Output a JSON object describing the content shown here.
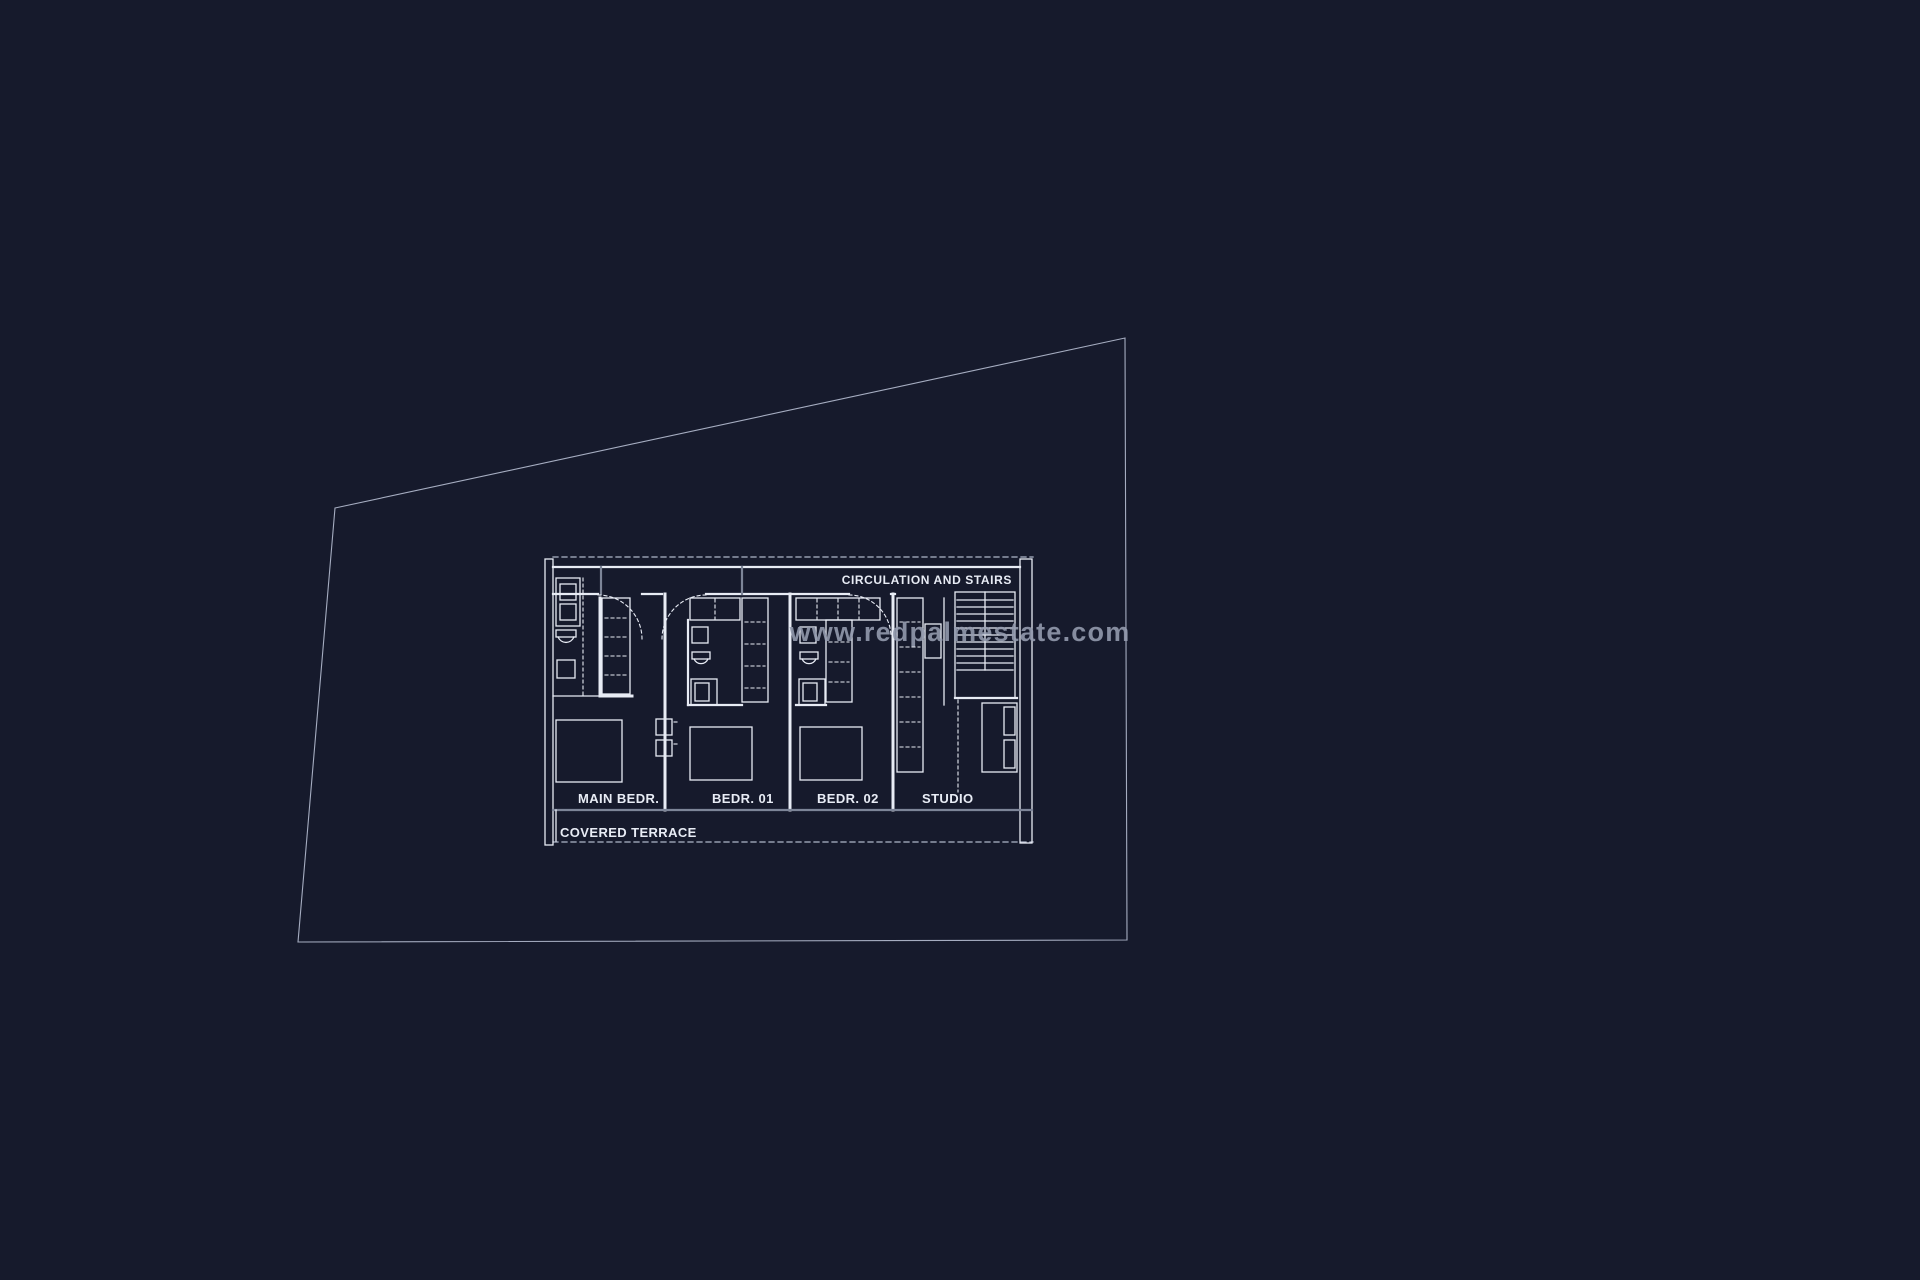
{
  "page": {
    "type": "architectural-floor-plan",
    "background_color": "#161a2c"
  },
  "watermark": {
    "text": "www.redpalmestate.com",
    "color": "#969db0"
  },
  "plan": {
    "labels": {
      "circulation": "CIRCULATION AND STAIRS",
      "main_bedroom": "MAIN BEDR.",
      "bedroom_1": "BEDR. 01",
      "bedroom_2": "BEDR. 02",
      "studio": "STUDIO",
      "terrace": "COVERED TERRACE"
    },
    "colors": {
      "line": "#e8ecf5",
      "dim_line": "#aeb6c9",
      "wall_gray": "#7d8598",
      "boundary": "#b6bed2",
      "watermark": "#969db0",
      "background": "#161a2c"
    }
  }
}
